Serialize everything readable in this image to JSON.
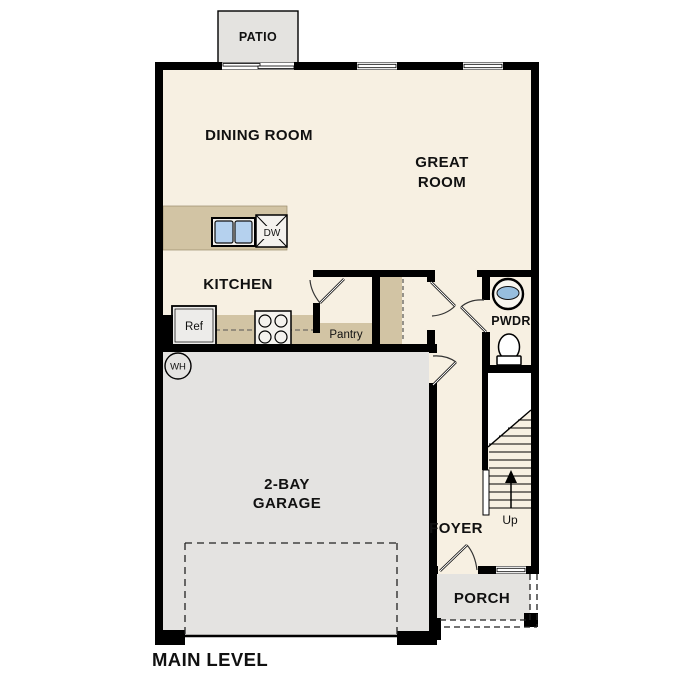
{
  "title": "MAIN LEVEL",
  "rooms": {
    "patio": {
      "label": "PATIO"
    },
    "dining": {
      "label": "DINING ROOM"
    },
    "great": {
      "line1": "GREAT",
      "line2": "ROOM"
    },
    "kitchen": {
      "label": "KITCHEN"
    },
    "pwdr": {
      "label": "PWDR"
    },
    "foyer": {
      "label": "FOYER"
    },
    "garage": {
      "line1": "2-BAY",
      "line2": "GARAGE"
    },
    "porch": {
      "label": "PORCH"
    }
  },
  "fixtures": {
    "dishwasher": "DW",
    "refrigerator": "Ref",
    "pantry": "Pantry",
    "water_heater": "WH",
    "stairs_up": "Up"
  },
  "colors": {
    "floor_cream": "#f7f0e2",
    "exterior_gray": "#e4e3e0",
    "cabinet_tan": "#d2c4a4",
    "sink_blue": "#b5d1ee",
    "wall_black": "#000000"
  }
}
